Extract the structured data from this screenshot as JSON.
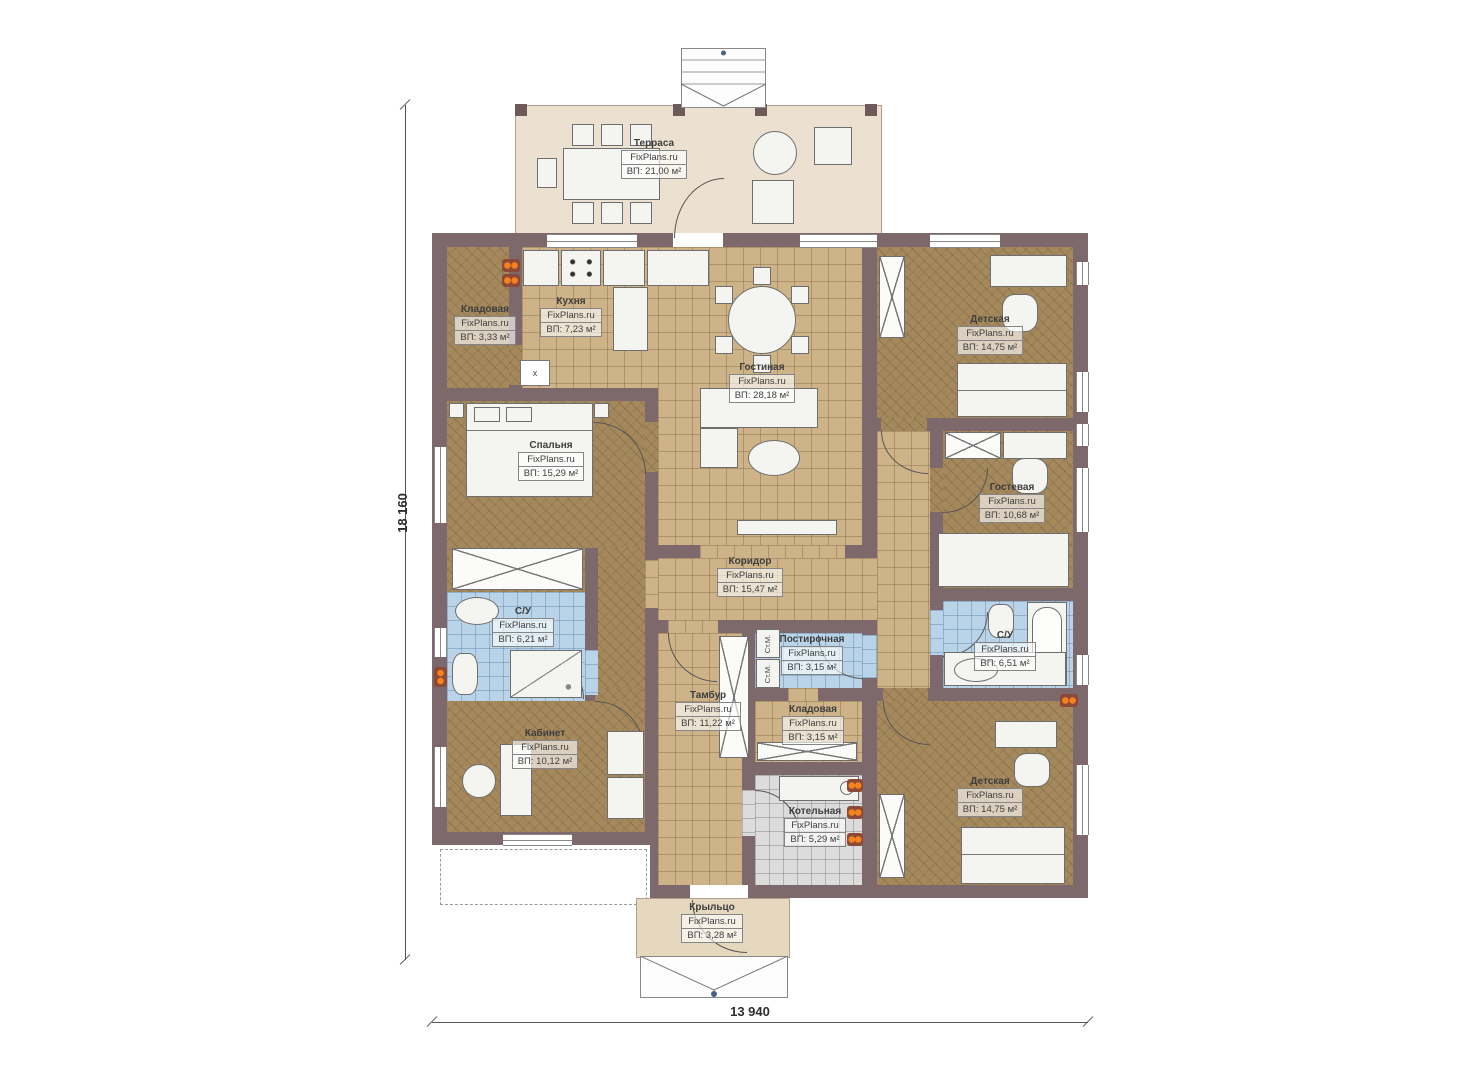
{
  "watermark": "FixPlans.ru",
  "dimensions": {
    "height": "18 160",
    "width": "13 940"
  },
  "rooms": {
    "terrace": {
      "name": "Терраса",
      "area": "ВП: 21,00 м²"
    },
    "storage_top": {
      "name": "Кладовая",
      "area": "ВП: 3,33 м²"
    },
    "kitchen": {
      "name": "Кухня",
      "area": "ВП: 7,23 м²"
    },
    "living_room": {
      "name": "Гостиная",
      "area": "ВП: 28,18 м²"
    },
    "nursery_top": {
      "name": "Детская",
      "area": "ВП: 14,75 м²"
    },
    "bedroom": {
      "name": "Спальня",
      "area": "ВП: 15,29 м²"
    },
    "guest_room": {
      "name": "Гостевая",
      "area": "ВП: 10,68 м²"
    },
    "corridor": {
      "name": "Коридор",
      "area": "ВП: 15,47 м²"
    },
    "bathroom_left": {
      "name": "С/У",
      "area": "ВП: 6,21 м²"
    },
    "laundry": {
      "name": "Постирочная",
      "area": "ВП: 3,15 м²"
    },
    "bathroom_right": {
      "name": "С/У",
      "area": "ВП: 6,51 м²"
    },
    "vestibule": {
      "name": "Тамбур",
      "area": "ВП: 11,22 м²"
    },
    "storage_bottom": {
      "name": "Кладовая",
      "area": "ВП: 3,15 м²"
    },
    "office": {
      "name": "Кабинет",
      "area": "ВП: 10,12 м²"
    },
    "boiler_room": {
      "name": "Котельная",
      "area": "ВП: 5,29 м²"
    },
    "nursery_bottom": {
      "name": "Детская",
      "area": "ВП: 14,75 м²"
    },
    "porch": {
      "name": "Крыльцо",
      "area": "ВП: 3,28 м²"
    }
  },
  "annotations": {
    "washing_machine": "Ст.М.",
    "storage_x": "x"
  },
  "colors": {
    "wall": "#7d686c",
    "tile_floor": "#cdb387",
    "wood_floor": "#a5895d",
    "bathroom_floor": "#b9d4e8",
    "boiler_floor": "#dcdcdc",
    "terrace_floor": "#ece1d1",
    "porch_floor": "#e6d7bf",
    "radiator": "#f5821f"
  }
}
